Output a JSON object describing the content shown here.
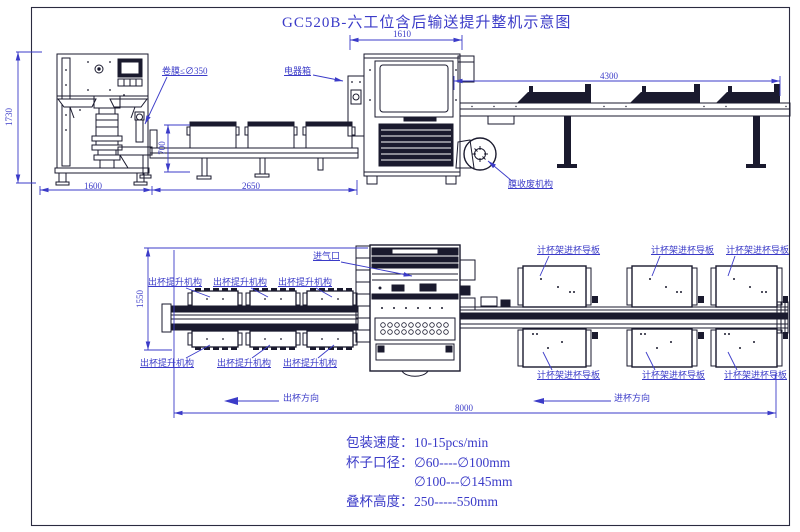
{
  "title": "GC520B-六工位含后输送提升整机示意图",
  "front_view": {
    "dims": {
      "d1610": "1610",
      "d4300": "4300",
      "d1730": "1730",
      "d700": "700",
      "d1600": "1600",
      "d2650": "2650"
    },
    "labels": {
      "film_roll": "卷膜≤∅350",
      "electric_box": "电器箱",
      "film_waste": "膜收废机构"
    }
  },
  "plan_view": {
    "dims": {
      "d1550": "1550",
      "d8000": "8000"
    },
    "air_inlet": "进气口",
    "lift_labels": [
      "出杯提升机构",
      "出杯提升机构",
      "出杯提升机构",
      "出杯提升机构",
      "出杯提升机构",
      "出杯提升机构"
    ],
    "guide_labels": [
      "计杯架进杯导板",
      "计杯架进杯导板",
      "计杯架进杯导板",
      "计杯架进杯导板",
      "计杯架进杯导板",
      "计杯架进杯导板"
    ],
    "dir_out": "出杯方向",
    "dir_in": "进杯方向"
  },
  "specs": {
    "rows": [
      {
        "label": "包装速度：",
        "value": "10-15pcs/min"
      },
      {
        "label": "杯子口径：",
        "value": "∅60----∅100mm"
      },
      {
        "label": "",
        "value": "∅100---∅145mm"
      },
      {
        "label": "叠杯高度：",
        "value": "250-----550mm"
      }
    ]
  },
  "colors": {
    "annotation": "#3b3bc8",
    "line": "#1a1a2e"
  }
}
